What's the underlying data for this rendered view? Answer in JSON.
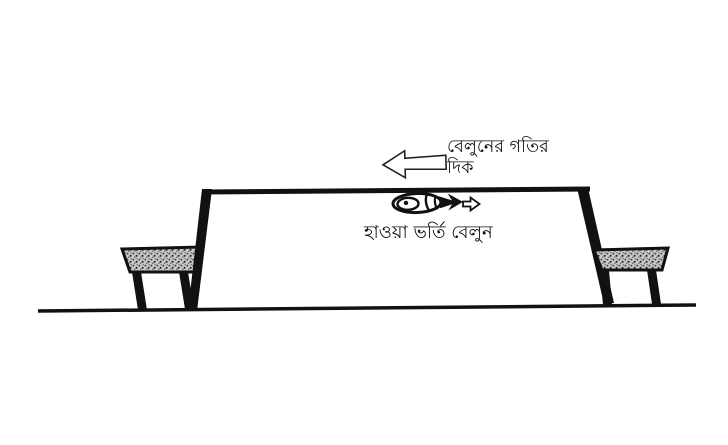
{
  "scene": {
    "kind": "physics-textbook-diagram",
    "labels": {
      "motion_direction_line1": "বেলুনের গতির",
      "motion_direction_line2": "দিক",
      "balloon_caption": "হাওয়া ভর্তি বেলুন"
    },
    "icons": {
      "motion_arrow": "left-block-arrow",
      "air_jet_arrow": "right-small-outline-arrow",
      "balloon": "deflating-balloon"
    },
    "colors": {
      "ink": "#111111",
      "paper": "#ffffff",
      "bench_seat_fill": "#c9c9c9"
    }
  }
}
